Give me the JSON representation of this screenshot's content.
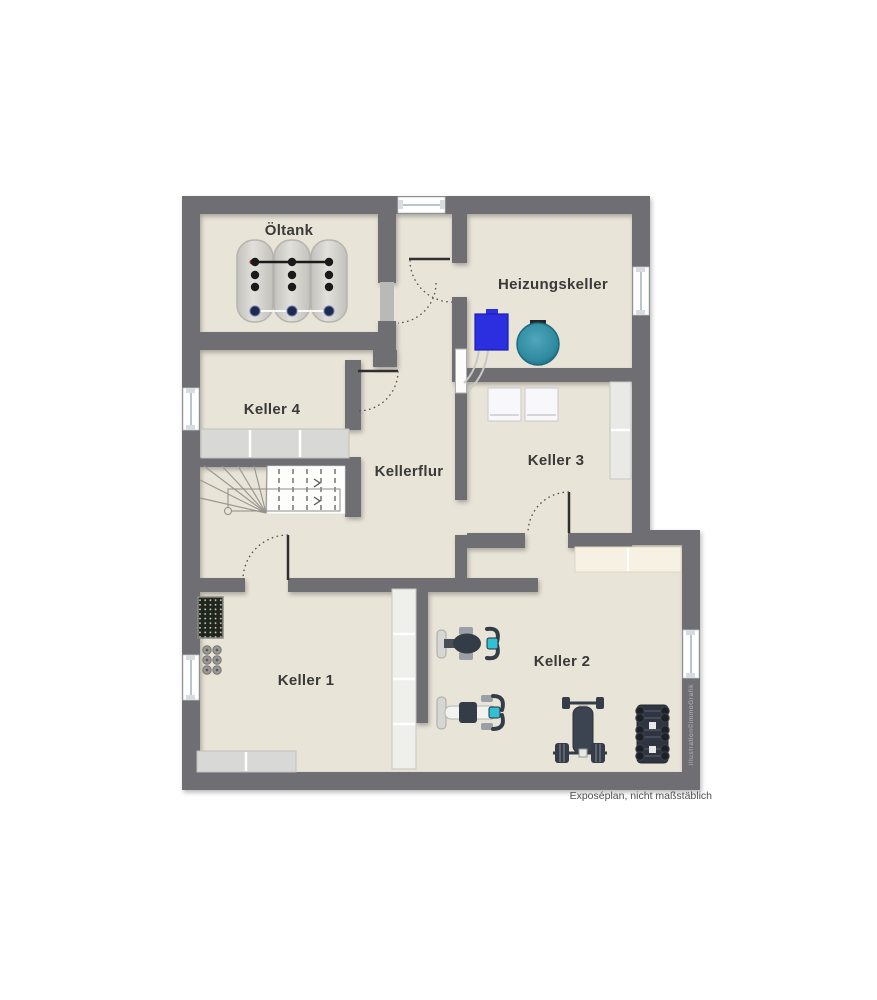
{
  "plan": {
    "caption": "Exposéplan, nicht maßstäblich",
    "watermark": "illustration©immoGrafik",
    "rooms": [
      {
        "id": "oeltank",
        "label": "Öltank"
      },
      {
        "id": "heizungskeller",
        "label": "Heizungskeller"
      },
      {
        "id": "keller4",
        "label": "Keller 4"
      },
      {
        "id": "kellerflur",
        "label": "Kellerflur"
      },
      {
        "id": "keller3",
        "label": "Keller 3"
      },
      {
        "id": "keller1",
        "label": "Keller 1"
      },
      {
        "id": "keller2",
        "label": "Keller 2"
      }
    ],
    "colors": {
      "background": "#ffffff",
      "wall": "#6e6e73",
      "floor": "#e9e4d8",
      "boiler_blue": "#2c2fe0",
      "water_tank_teal": "#2f8ba1",
      "equipment_dark": "#343c47",
      "screen_teal": "#35bfd6",
      "shelf_gray": "#d8d8d6",
      "shelf_cream": "#f6f1e2",
      "label_text": "#3a3a3a"
    }
  }
}
